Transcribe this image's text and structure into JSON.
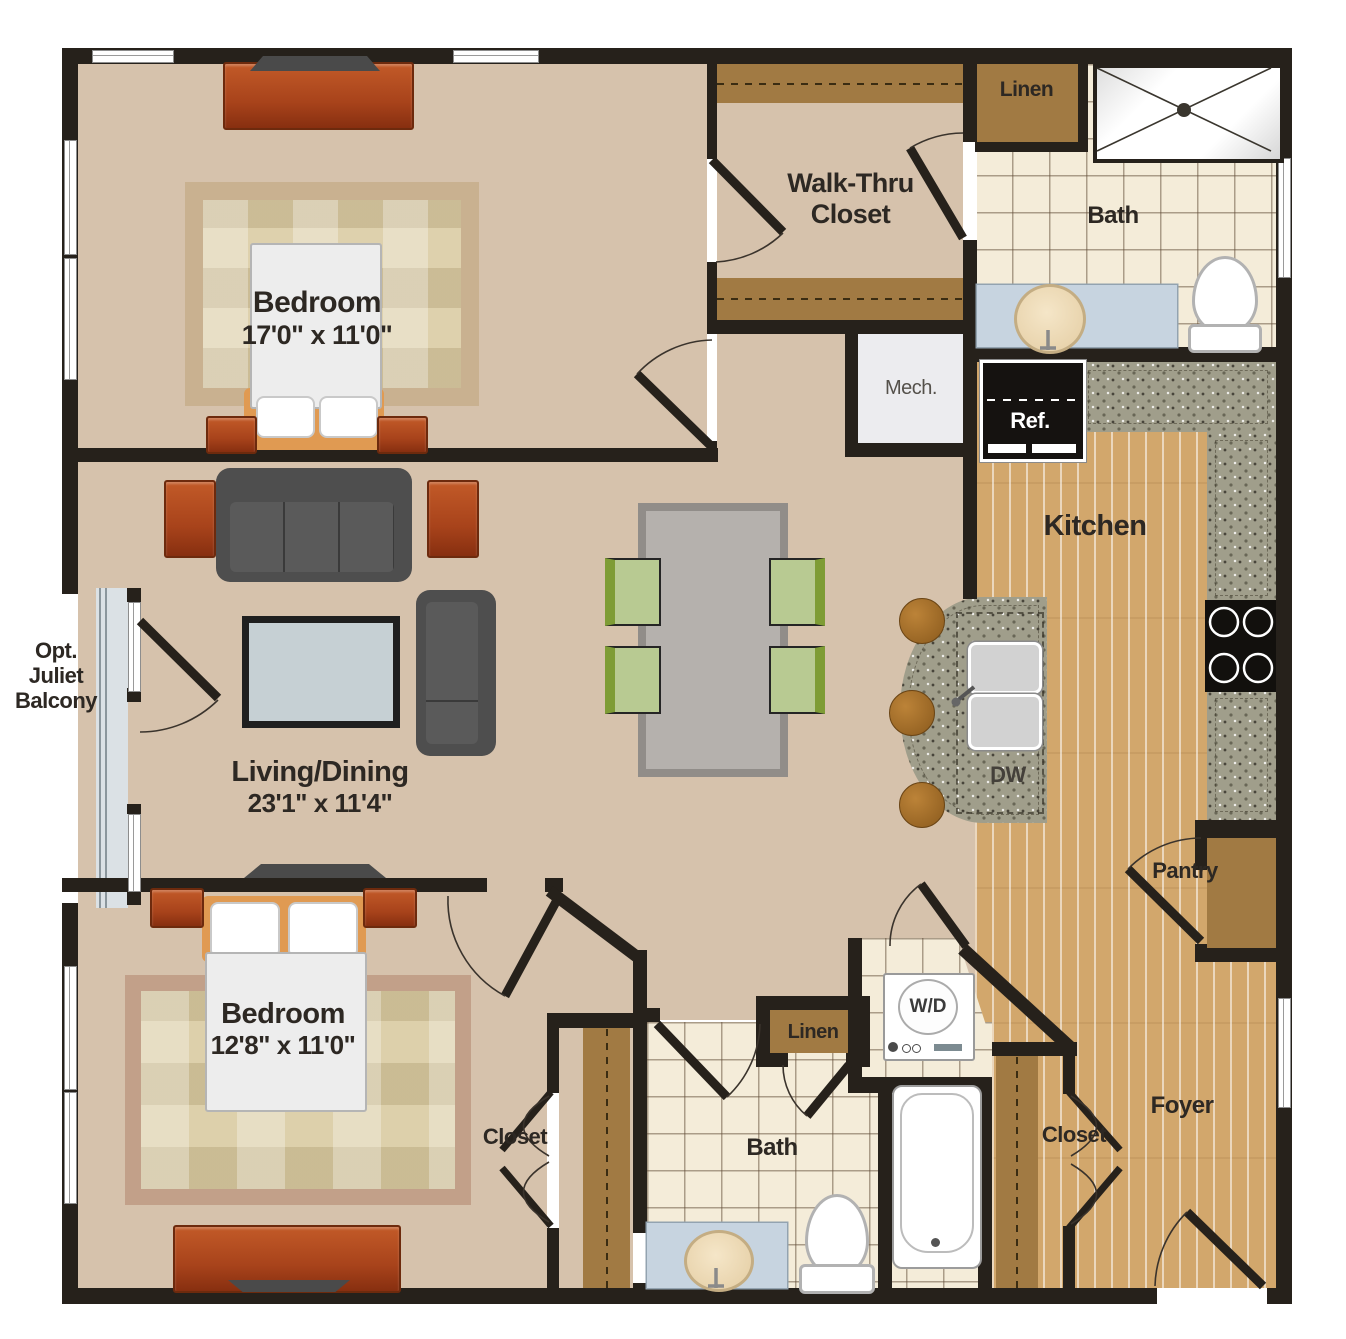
{
  "rooms": {
    "bedroom_top": {
      "label": "Bedroom",
      "dims": "17'0\" x 11'0\""
    },
    "walk_thru_closet": {
      "label": "Walk-Thru Closet"
    },
    "linen_top": {
      "label": "Linen"
    },
    "bath_top": {
      "label": "Bath"
    },
    "mech": {
      "label": "Mech."
    },
    "kitchen": {
      "label": "Kitchen"
    },
    "living_dining": {
      "label": "Living/Dining",
      "dims": "23'1\" x 11'4\""
    },
    "juliet_balcony": {
      "label": "Opt. Juliet Balcony"
    },
    "bedroom_bottom": {
      "label": "Bedroom",
      "dims": "12'8\" x 11'0\""
    },
    "closet_bedroom": {
      "label": "Closet"
    },
    "linen_bottom": {
      "label": "Linen"
    },
    "bath_bottom": {
      "label": "Bath"
    },
    "pantry": {
      "label": "Pantry"
    },
    "closet_foyer": {
      "label": "Closet"
    },
    "foyer": {
      "label": "Foyer"
    }
  },
  "appliances": {
    "refrigerator": {
      "label": "Ref."
    },
    "dishwasher": {
      "label": "DW"
    },
    "washer_dryer": {
      "label": "W/D"
    }
  },
  "colors": {
    "wall": "#26211b",
    "floor_beige": "#d6c2ac",
    "tile": "#f4ecd9",
    "wood": "#d2a76c",
    "granite": "#a09e8b",
    "cabinet_brown": "#a17a43",
    "furniture_rust": "#b04a1e",
    "vanity_blue": "#c7d4e0",
    "chair_green": "#7e9c35",
    "balcony_gray": "#dbe1e5"
  }
}
